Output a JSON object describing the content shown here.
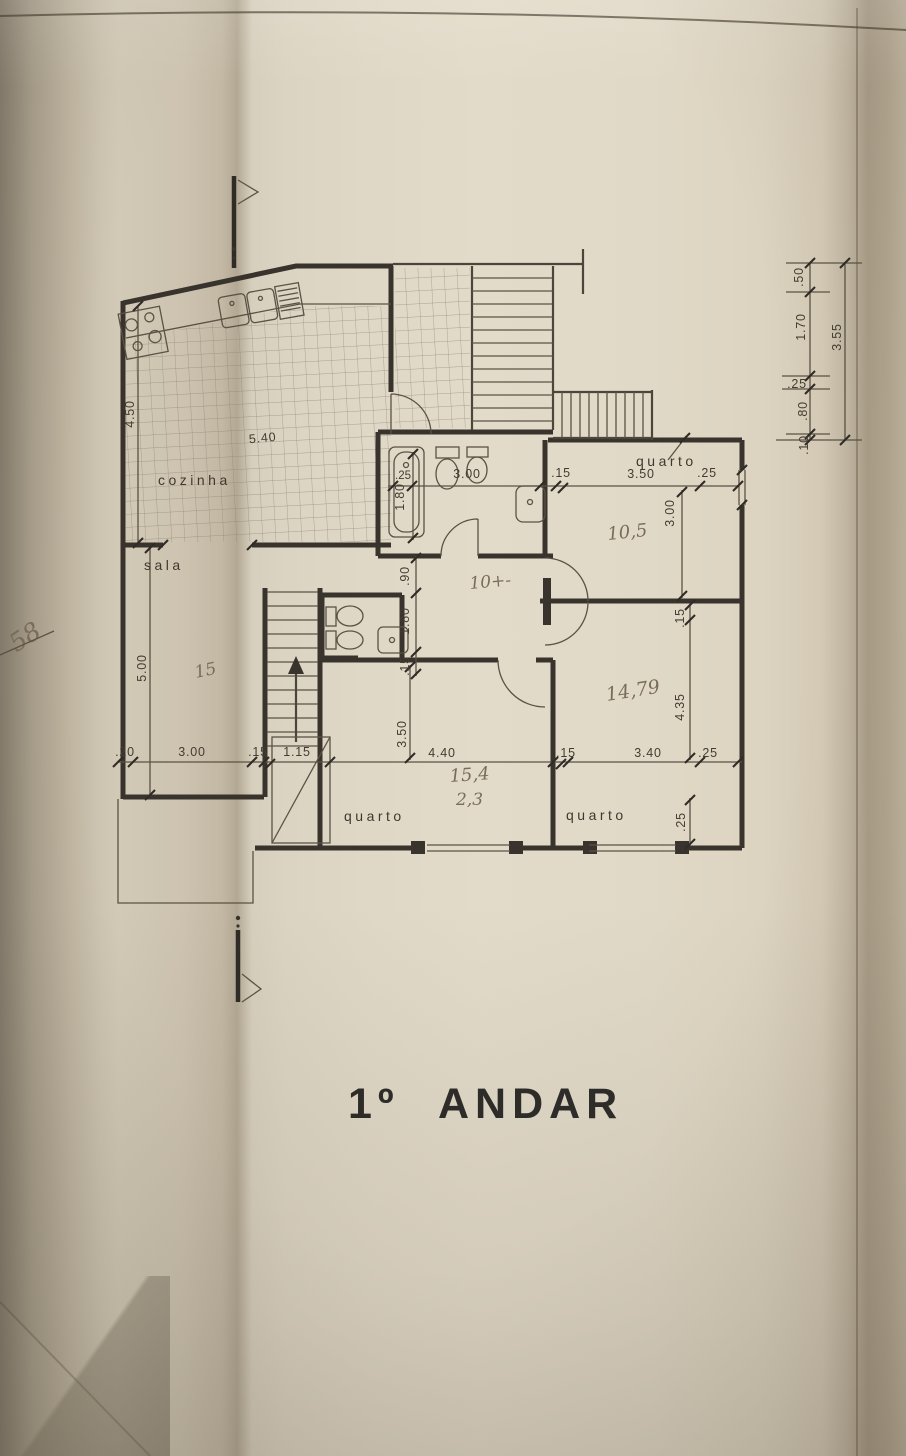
{
  "title": "1º ANDAR",
  "plan": {
    "rooms": {
      "kitchen": "cozinha",
      "living": "sala",
      "bedroom_top_right": "quarto",
      "bedroom_center": "quarto",
      "bedroom_bottom_right": "quarto"
    },
    "dims": {
      "kitchen_height": "4.50",
      "kitchen_width": "5.40",
      "living_height": "5.00",
      "bottom_offset": ".20",
      "bottom_living": "3.00",
      "bottom_wall": ".15",
      "bottom_stair": "1.15",
      "bottom_center": "4.40",
      "bottom_wall2": ".15",
      "bottom_right": "3.40",
      "bottom_offset2": ".25",
      "center_height": "3.50",
      "bath_offset": ".25",
      "bath_tub": "1.80",
      "bath_width": "3.00",
      "bath_wall": ".15",
      "tr_width": "3.50",
      "tr_offset": ".25",
      "tr_height": "3.00",
      "wc_a": ".90",
      "wc_b": "1.80",
      "wc_c": ".15",
      "br_wall": ".15",
      "br_height": "4.35",
      "br_sill": ".25",
      "side_a": ".50",
      "side_b": "1.70",
      "side_c": ".25",
      "side_d": ".80",
      "side_e": ".10",
      "side_total": "3.55"
    },
    "handwritten": {
      "corner_note": "58",
      "living_area": "15",
      "hall_area": "10+-",
      "tr_area": "10,5",
      "br_area": "14,79",
      "center_area_a": "15,4",
      "center_area_b": "2,3"
    }
  }
}
